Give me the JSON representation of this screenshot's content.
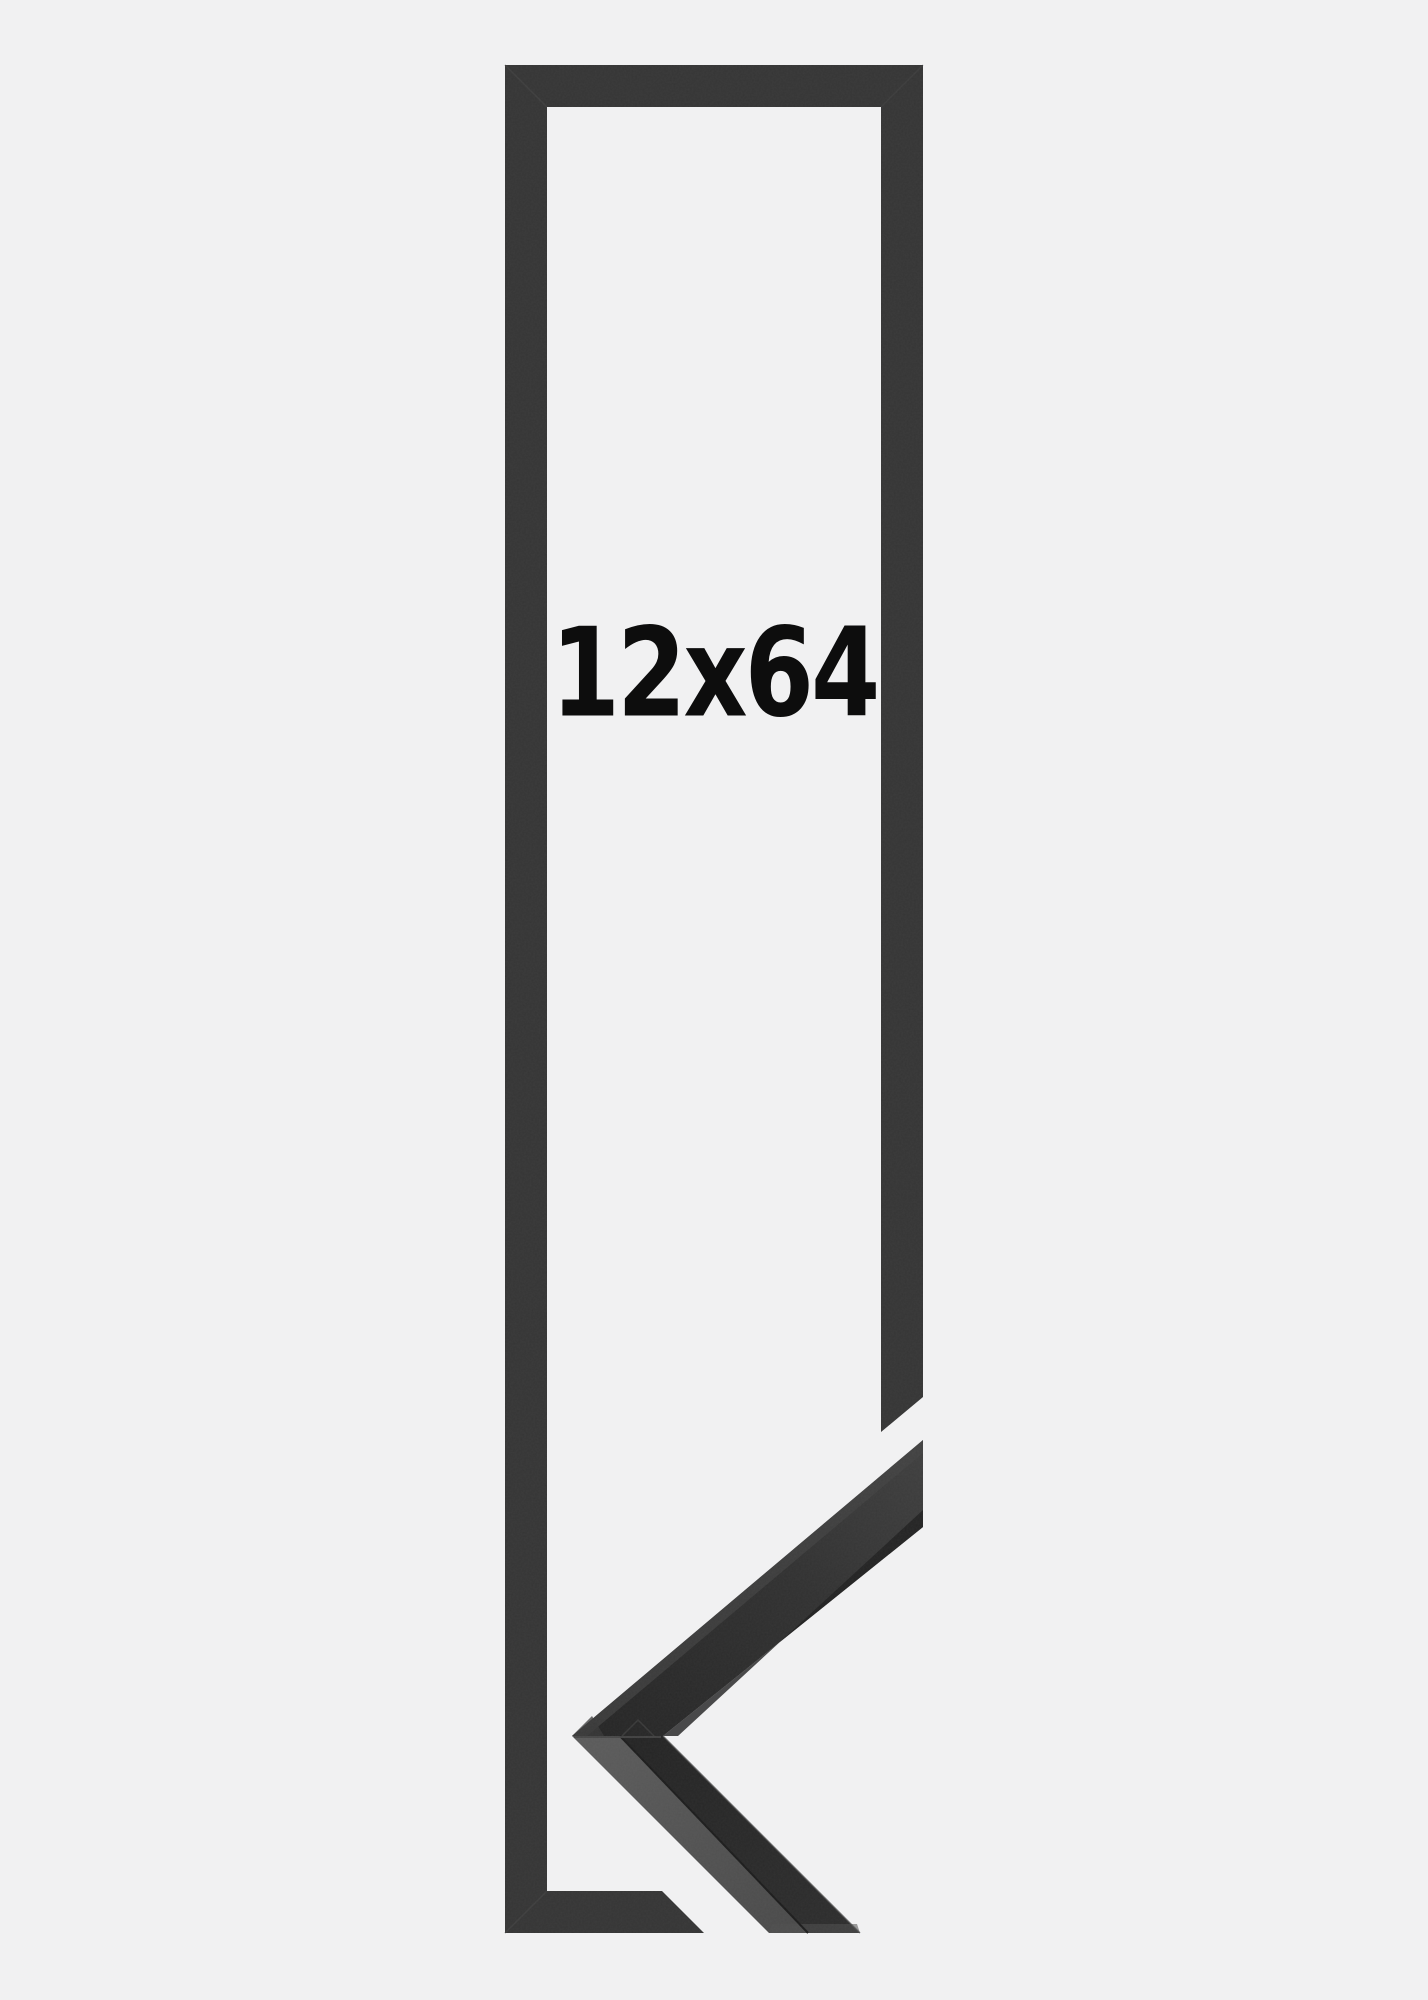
{
  "product": {
    "size_label": "12x64"
  },
  "colors": {
    "background": "#f1f1f2",
    "frame": "#353535",
    "frame-seam": "#454545",
    "label-text": "#0d0d0d",
    "sample-face-dark": "#262626",
    "sample-face-light": "#3e3e3e",
    "sample-bevel": "#434343",
    "sample-inner-strip": "#1f1f1f",
    "sample-side-light": "#5a5a5a",
    "sample-side-shade": "#4a4a4a",
    "sample-edge-dark": "#1c1c1c",
    "sample-edge-highlight": "#505050"
  }
}
